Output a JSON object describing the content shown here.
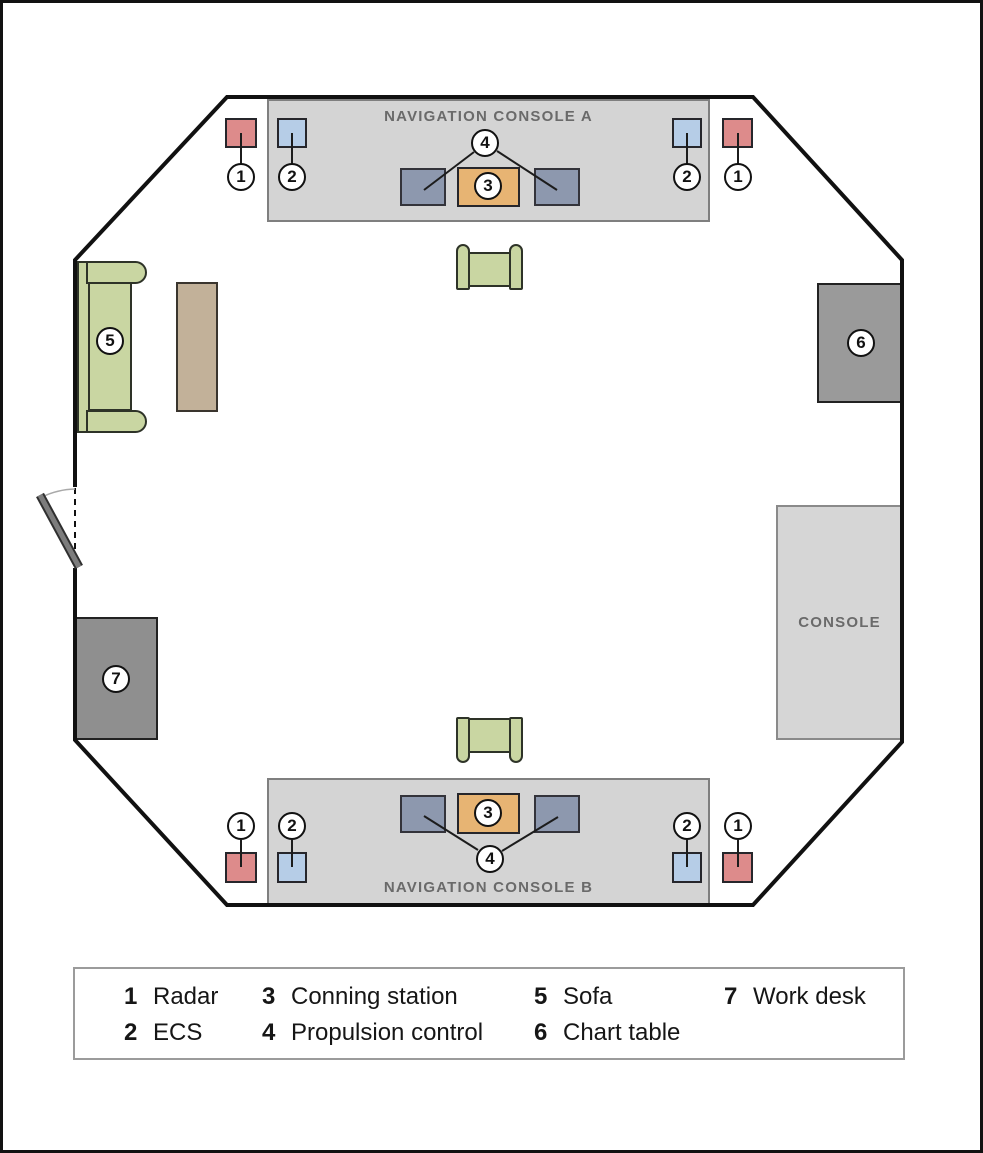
{
  "floorplan": {
    "console_a_label": "NAVIGATION CONSOLE A",
    "console_b_label": "NAVIGATION CONSOLE B",
    "side_console_label": "CONSOLE"
  },
  "badges": {
    "radar": "1",
    "ecs": "2",
    "conning_station": "3",
    "propulsion_control": "4",
    "sofa": "5",
    "chart_table": "6",
    "work_desk": "7"
  },
  "legend": {
    "items": [
      {
        "num": "1",
        "label": "Radar"
      },
      {
        "num": "2",
        "label": "ECS"
      },
      {
        "num": "3",
        "label": "Conning station"
      },
      {
        "num": "4",
        "label": "Propulsion control"
      },
      {
        "num": "5",
        "label": "Sofa"
      },
      {
        "num": "6",
        "label": "Chart table"
      },
      {
        "num": "7",
        "label": "Work desk"
      }
    ]
  },
  "colors": {
    "radar_red": "#dd8b8b",
    "ecs_blue": "#b6cde7",
    "propulsion_slate": "#8d98ae",
    "conning_orange": "#e7b473",
    "seating_green": "#c9d6a2",
    "table_tan": "#c2b199",
    "work_desk_gray": "#8f8f8f",
    "chart_table_gray": "#9a9a9a",
    "console_gray": "#d4d4d4",
    "wall_black": "#111111",
    "label_gray": "#6a6a6a"
  }
}
